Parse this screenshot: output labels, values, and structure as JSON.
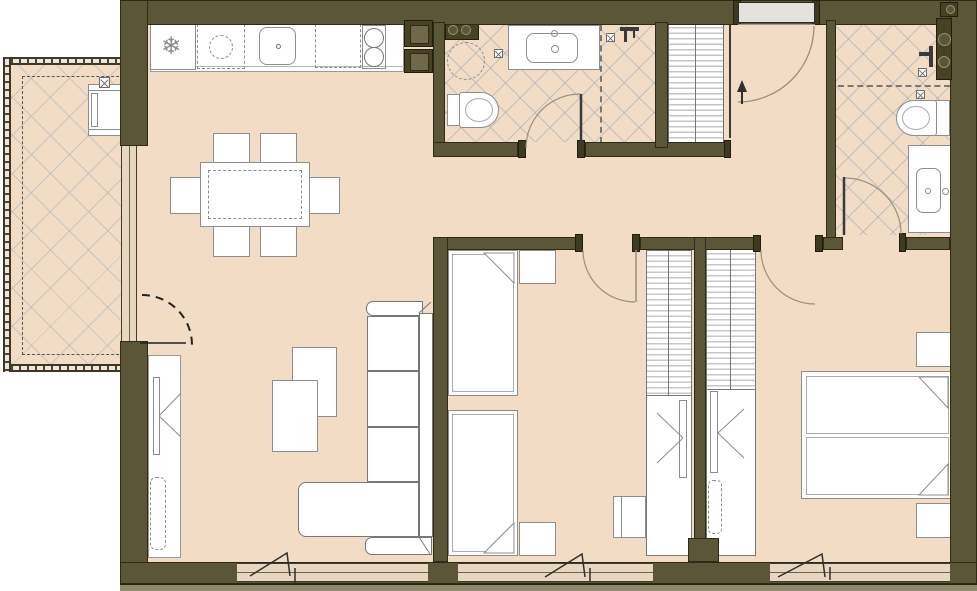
{
  "meta": {
    "type": "apartment-floor-plan",
    "text_labels": "none-visible"
  },
  "icons": {
    "fridge_snowflake": "❄",
    "drain": "x-box-icon",
    "shower_head": "shower-icon",
    "entry_arrow": "up-arrow-icon"
  },
  "colors": {
    "wall": "#5b5637",
    "wall_edge": "#2e2a16",
    "floor": "#f2dcc6",
    "tile_line": "#9aa8b4",
    "fixture_outline": "#8d8d8d",
    "door_arc": "#9b907b",
    "entrance_door": "#e4e2dd",
    "exterior_strip": "#8f8a6d"
  },
  "rooms": [
    {
      "name": "living-dining-kitchen",
      "fixtures": [
        "kitchen-counter",
        "fridge",
        "dishwasher-space",
        "kitchen-sink",
        "cooktop-2-burner",
        "dining-table",
        "six-chairs",
        "corner-sofa",
        "two-coffee-tables",
        "storage-unit",
        "balcony-door"
      ]
    },
    {
      "name": "balcony",
      "fixtures": [
        "railing",
        "tiled-floor",
        "ac-unit"
      ]
    },
    {
      "name": "bathroom-1",
      "fixtures": [
        "washing-machine-space",
        "vanity-sink",
        "toilet",
        "shower-zone",
        "floor-drains",
        "pipe-shaft"
      ]
    },
    {
      "name": "hallway",
      "fixtures": [
        "entrance-door",
        "coat-closet"
      ]
    },
    {
      "name": "bedroom-1",
      "fixtures": [
        "single-bed",
        "single-bed",
        "nightstand",
        "nightstand",
        "desk",
        "desk-chair",
        "wardrobe",
        "window"
      ]
    },
    {
      "name": "bedroom-2-master",
      "fixtures": [
        "double-bed",
        "nightstand",
        "nightstand",
        "wardrobe",
        "window"
      ]
    },
    {
      "name": "bathroom-2",
      "fixtures": [
        "shower-zone",
        "toilet",
        "vanity-sink",
        "floor-drains",
        "pipe-shaft"
      ]
    }
  ]
}
